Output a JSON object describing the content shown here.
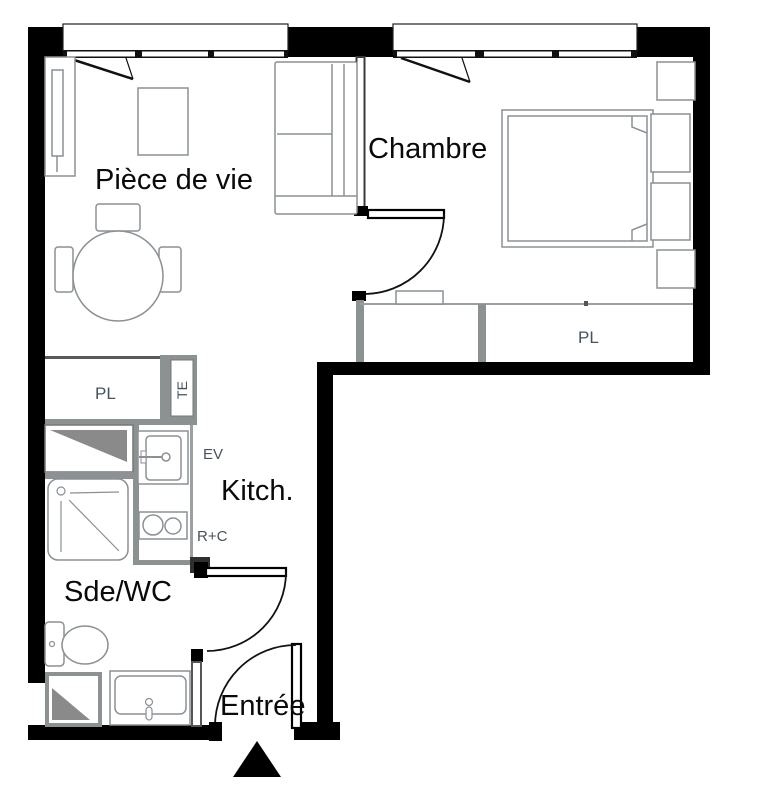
{
  "rooms": [
    {
      "id": "piece-de-vie",
      "label": "Pièce de vie"
    },
    {
      "id": "chambre",
      "label": "Chambre"
    },
    {
      "id": "kitchen",
      "label": "Kitch."
    },
    {
      "id": "sde-wc",
      "label": "Sde/WC"
    },
    {
      "id": "entree",
      "label": "Entrée"
    }
  ],
  "annotations": [
    {
      "id": "closet-left",
      "label": "PL"
    },
    {
      "id": "electrical-panel",
      "label": "TE"
    },
    {
      "id": "sink",
      "label": "EV"
    },
    {
      "id": "fridge-cooktop",
      "label": "R+C"
    },
    {
      "id": "closet-bedroom",
      "label": "PL"
    }
  ],
  "colors": {
    "wall": "#000000",
    "label_large": "#0a0a0a",
    "label_small": "#46525e",
    "furniture_outline": "#8a9094",
    "partition_gray": "#8c9191",
    "appliance_fill": "#8a8a8a",
    "background": "#ffffff"
  }
}
